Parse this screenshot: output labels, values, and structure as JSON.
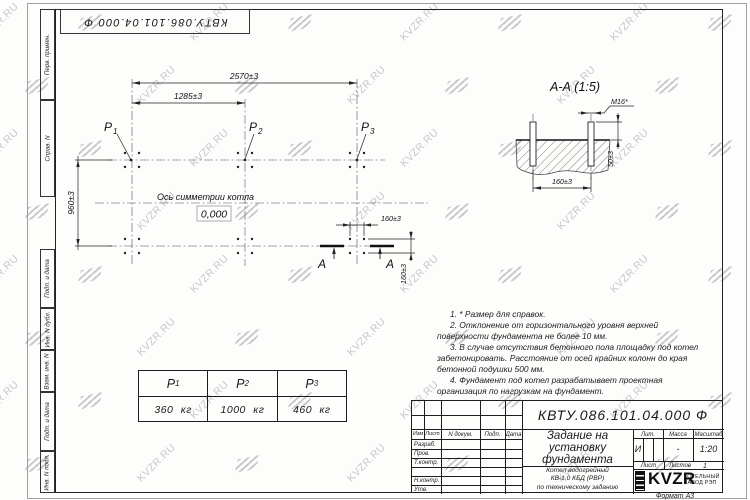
{
  "watermark": {
    "text": "KVZR.RU"
  },
  "corner_stamp": {
    "designation": "КВТУ.086.101.04.000  Ф"
  },
  "side_labels": {
    "perv": "Перв. примен.",
    "sprav": "Справ. N",
    "podp_data1": "Подп. и дата",
    "inv_dubl": "Инв. N дубл.",
    "vzam": "Взам. инв. N",
    "podp_data2": "Подп. и дата",
    "inv_podl": "Инв. N подл."
  },
  "plan": {
    "dim_span_total": "2570±3",
    "dim_span_half": "1285±3",
    "dim_depth": "960±3",
    "dim_bolt_x": "160±3",
    "dim_bolt_y": "160±3",
    "p_labels": [
      {
        "base": "P",
        "sub": "1"
      },
      {
        "base": "P",
        "sub": "2"
      },
      {
        "base": "P",
        "sub": "3"
      }
    ],
    "axis_label": "Ось симметрии котла",
    "elevation": "0,000",
    "section_letters": [
      "А",
      "А"
    ]
  },
  "section": {
    "title": "А-А  (1:5)",
    "bolt_thread": "М16*",
    "dim_spacing": "160±3",
    "dim_protrusion": "50±3"
  },
  "notes": [
    "1. * Размер для справок.",
    "2. Отклонение от горизонтального уровня верхней поверхности фундамента не более 10 мм.",
    "3. В случае отсутствия бетонного пола площадку под котел забетонировать. Расстояние от осей крайних колонн до края бетонной подушки 500 мм.",
    "4. Фундамент под котел разрабатывает проектная организация по нагрузкам на фундамент."
  ],
  "load_table": {
    "headers": [
      {
        "base": "P",
        "sub": "1"
      },
      {
        "base": "P",
        "sub": "2"
      },
      {
        "base": "P",
        "sub": "3"
      }
    ],
    "values": [
      "360 кг",
      "1000 кг",
      "460 кг"
    ]
  },
  "title_block": {
    "designation": "КВТУ.086.101.04.000  Ф",
    "doc_title_lines": [
      "Задание на",
      "установку",
      "фундамента"
    ],
    "product_lines": [
      "Котел водогрейный",
      "КВ-1,0 КБД (РВР)",
      "по техническому заданию"
    ],
    "cols": {
      "izm": "Изм",
      "list": "Лист",
      "ndoc": "N докум.",
      "podp": "Подп.",
      "data": "Дата"
    },
    "rows": [
      "Разраб.",
      "Пров.",
      "Т.контр.",
      "Н.контр.",
      "Утв."
    ],
    "lit_label": "Лит.",
    "mass_label": "Масса",
    "scale_label": "Масштаб",
    "lit_value": "И",
    "mass_value": "-",
    "scale_value": "1:20",
    "sheet_label": "Лист",
    "sheets_label": "Листов",
    "sheets_value": "1",
    "brand": "KVZR",
    "company_lines": [
      "КОТЕЛЬНЫЙ",
      "ЗАВОД РЭП"
    ]
  },
  "sheet": {
    "format": "Формат А3"
  }
}
